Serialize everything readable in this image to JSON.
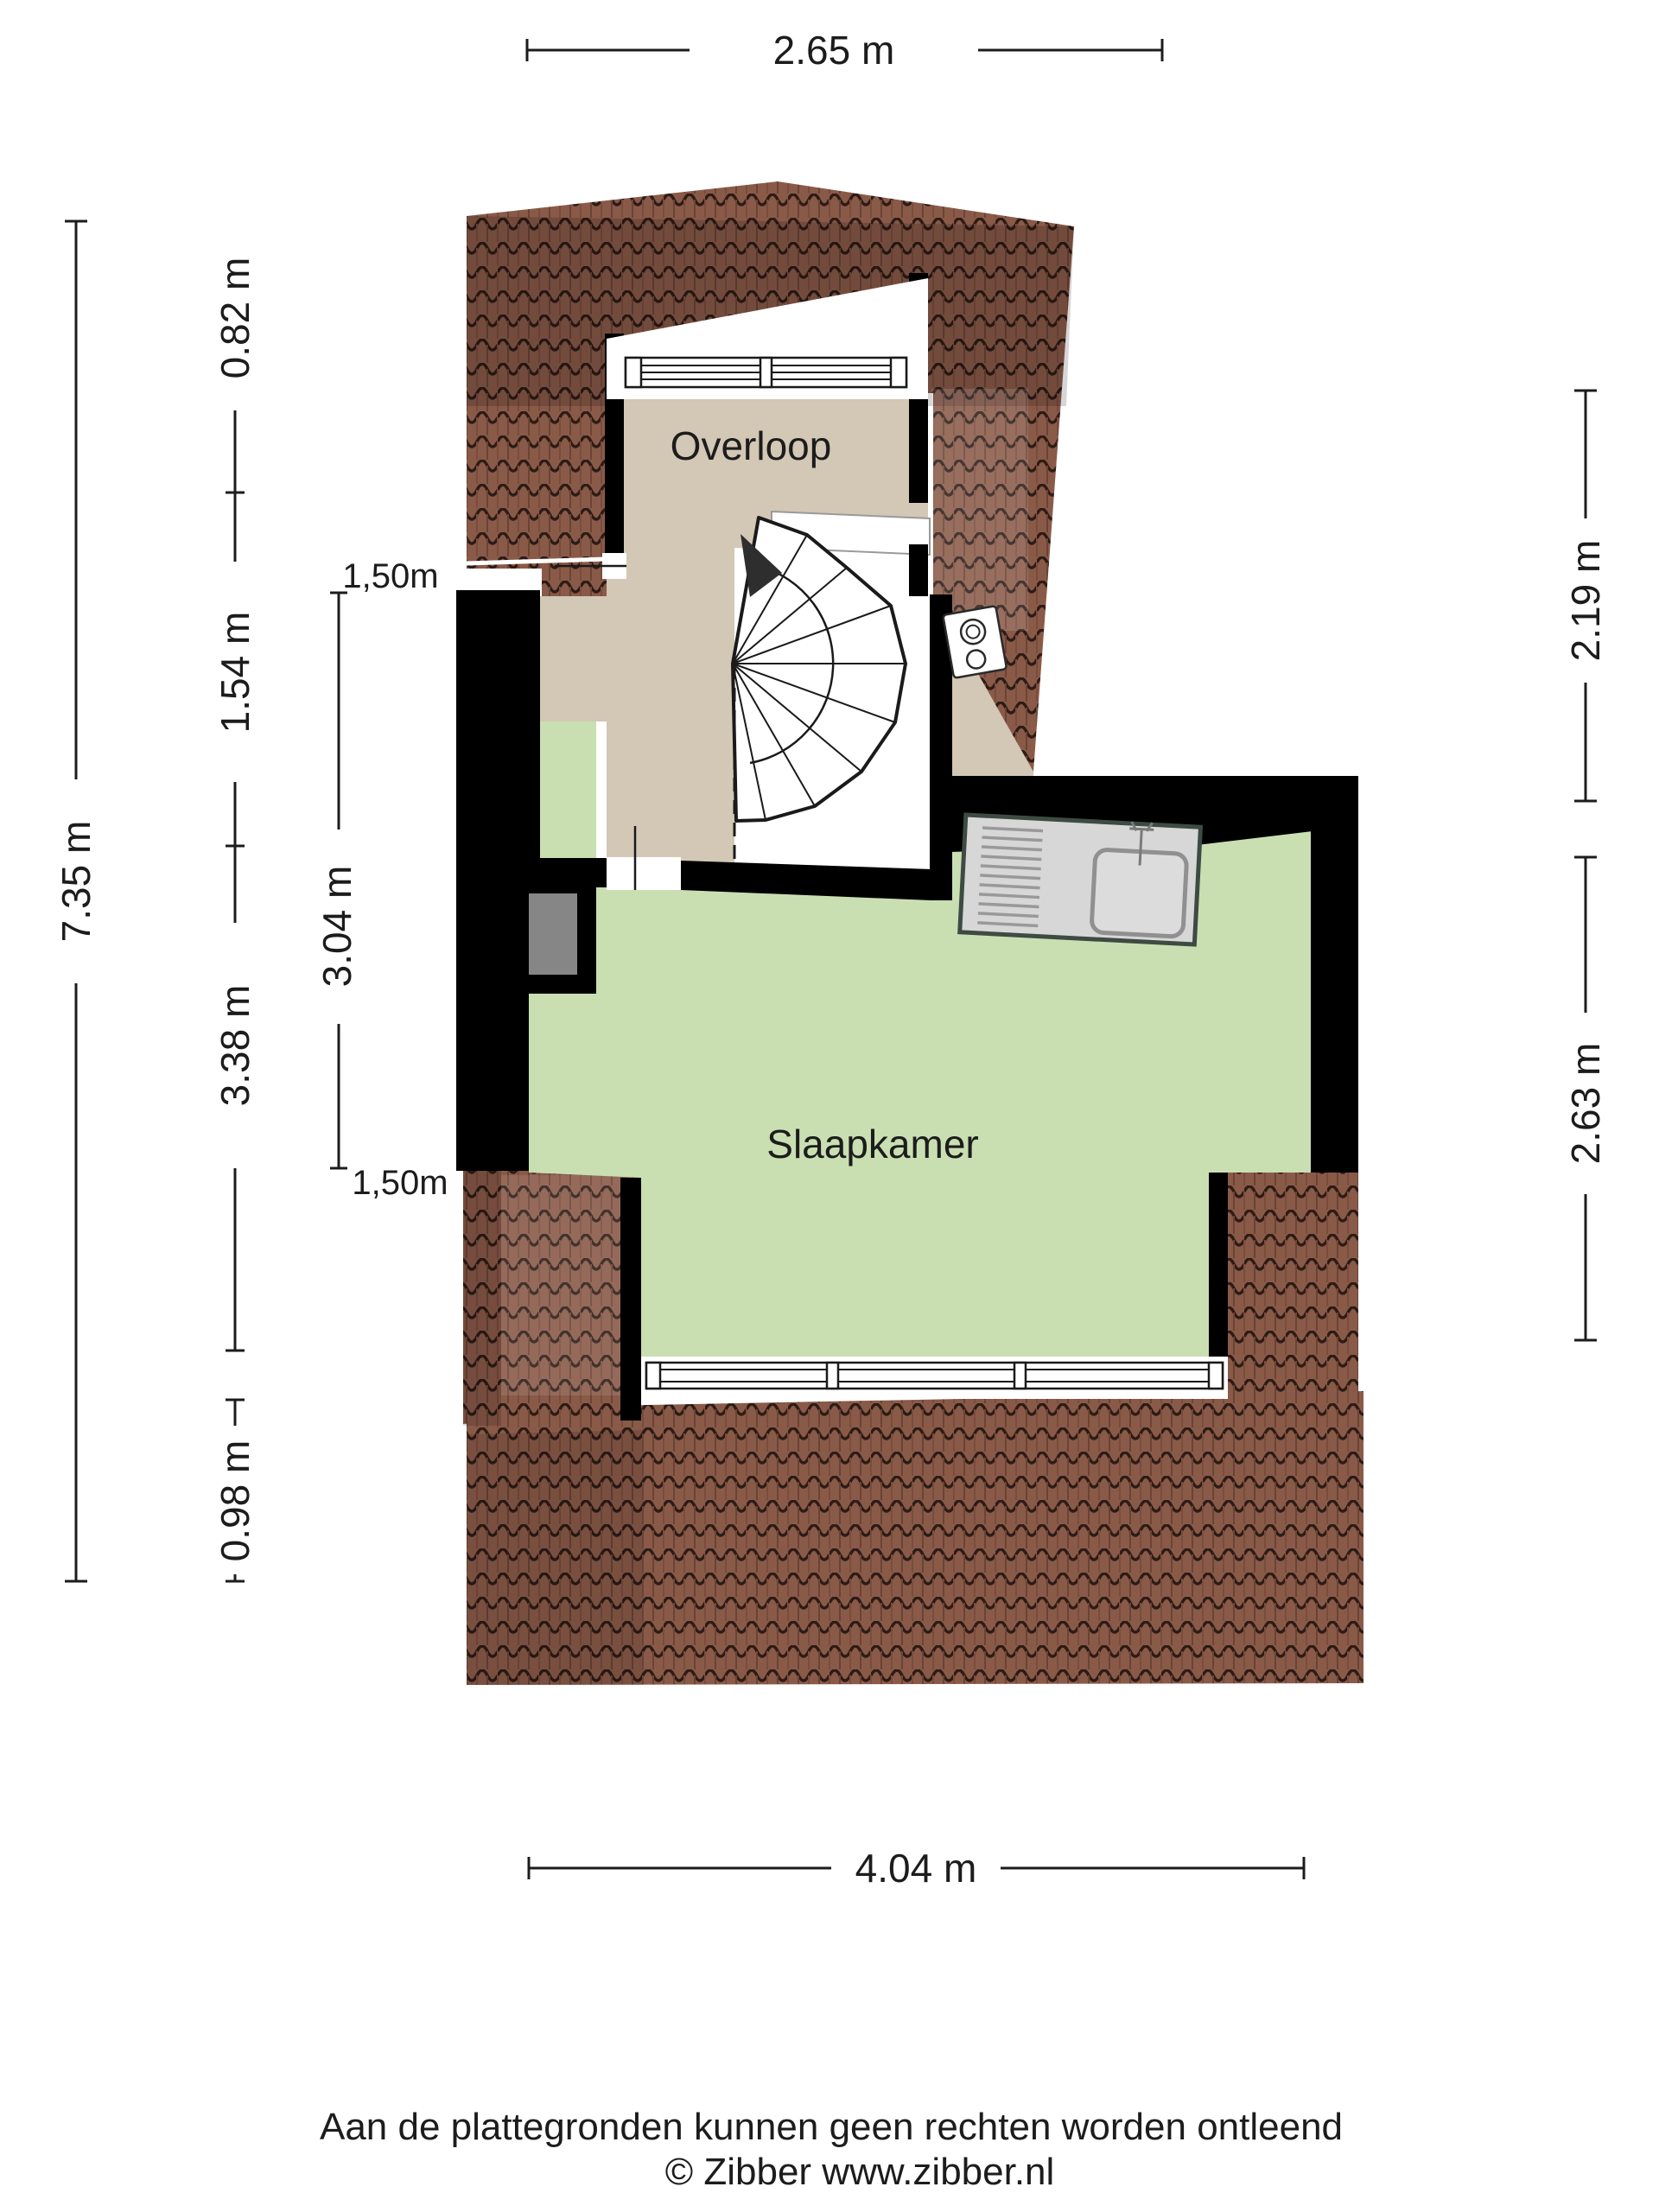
{
  "floorplan": {
    "rooms": [
      {
        "name": "overloop",
        "label": "Overloop"
      },
      {
        "name": "slaapkamer",
        "label": "Slaapkamer"
      }
    ],
    "colors": {
      "roof_tile": "#8a5a49",
      "roof_tile_line": "#2d1c16",
      "wall": "#000000",
      "floor_overloop": "#d3c7b5",
      "floor_slaapkamer": "#c9dfb2",
      "radiator": "#868686",
      "sink_fill": "#d7d7d7",
      "sink_border": "#3d4b43"
    }
  },
  "dimensions": {
    "top": "2.65 m",
    "left_total": "7.35 m",
    "left_chain": [
      "0.82 m",
      "1.54 m",
      "3.38 m",
      "0.98 m"
    ],
    "headroom_top": "1,50m",
    "headroom_span": "3.04 m",
    "headroom_bottom": "1,50m",
    "right_chain": [
      "2.19 m",
      "2.63 m"
    ],
    "bottom": "4.04 m"
  },
  "footer": {
    "line1": "Aan de plattegronden kunnen geen rechten worden ontleend",
    "line2": "© Zibber www.zibber.nl"
  }
}
